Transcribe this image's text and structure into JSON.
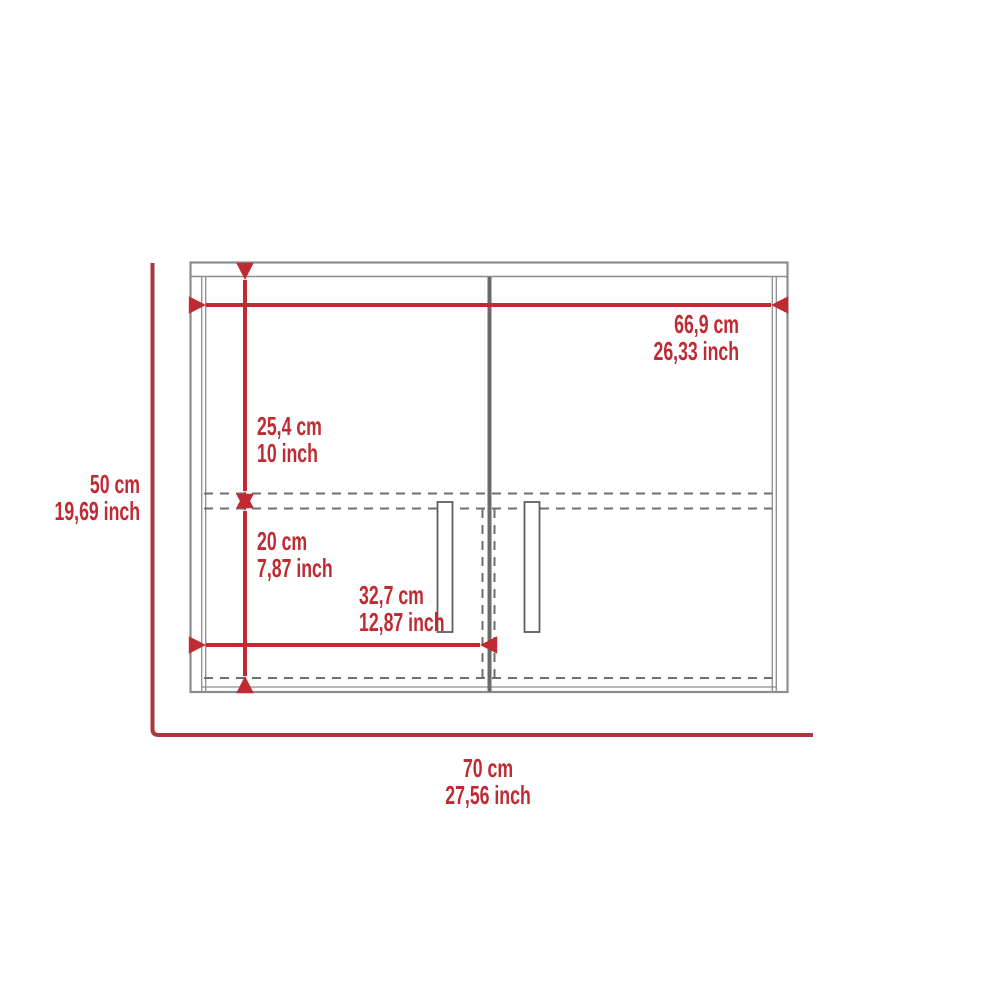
{
  "diagram": {
    "colors": {
      "dimension_red": "#bf2a33",
      "bracket_red": "#a7393f",
      "cabinet_outline": "#8c8c8c",
      "center_divider": "#6a6a6a",
      "hidden_dashed_line": "#6f6f6f",
      "background": "#ffffff"
    },
    "dimensions": {
      "inner_width": {
        "cm": "66,9 cm",
        "inch": "26,33 inch"
      },
      "upper_section_height": {
        "cm": "25,4 cm",
        "inch": "10 inch"
      },
      "overall_height": {
        "cm": "50 cm",
        "inch": "19,69 inch"
      },
      "lower_section_height": {
        "cm": "20 cm",
        "inch": "7,87 inch"
      },
      "door_section_width": {
        "cm": "32,7 cm",
        "inch": "12,87 inch"
      },
      "overall_width": {
        "cm": "70 cm",
        "inch": "27,56 inch"
      }
    }
  }
}
